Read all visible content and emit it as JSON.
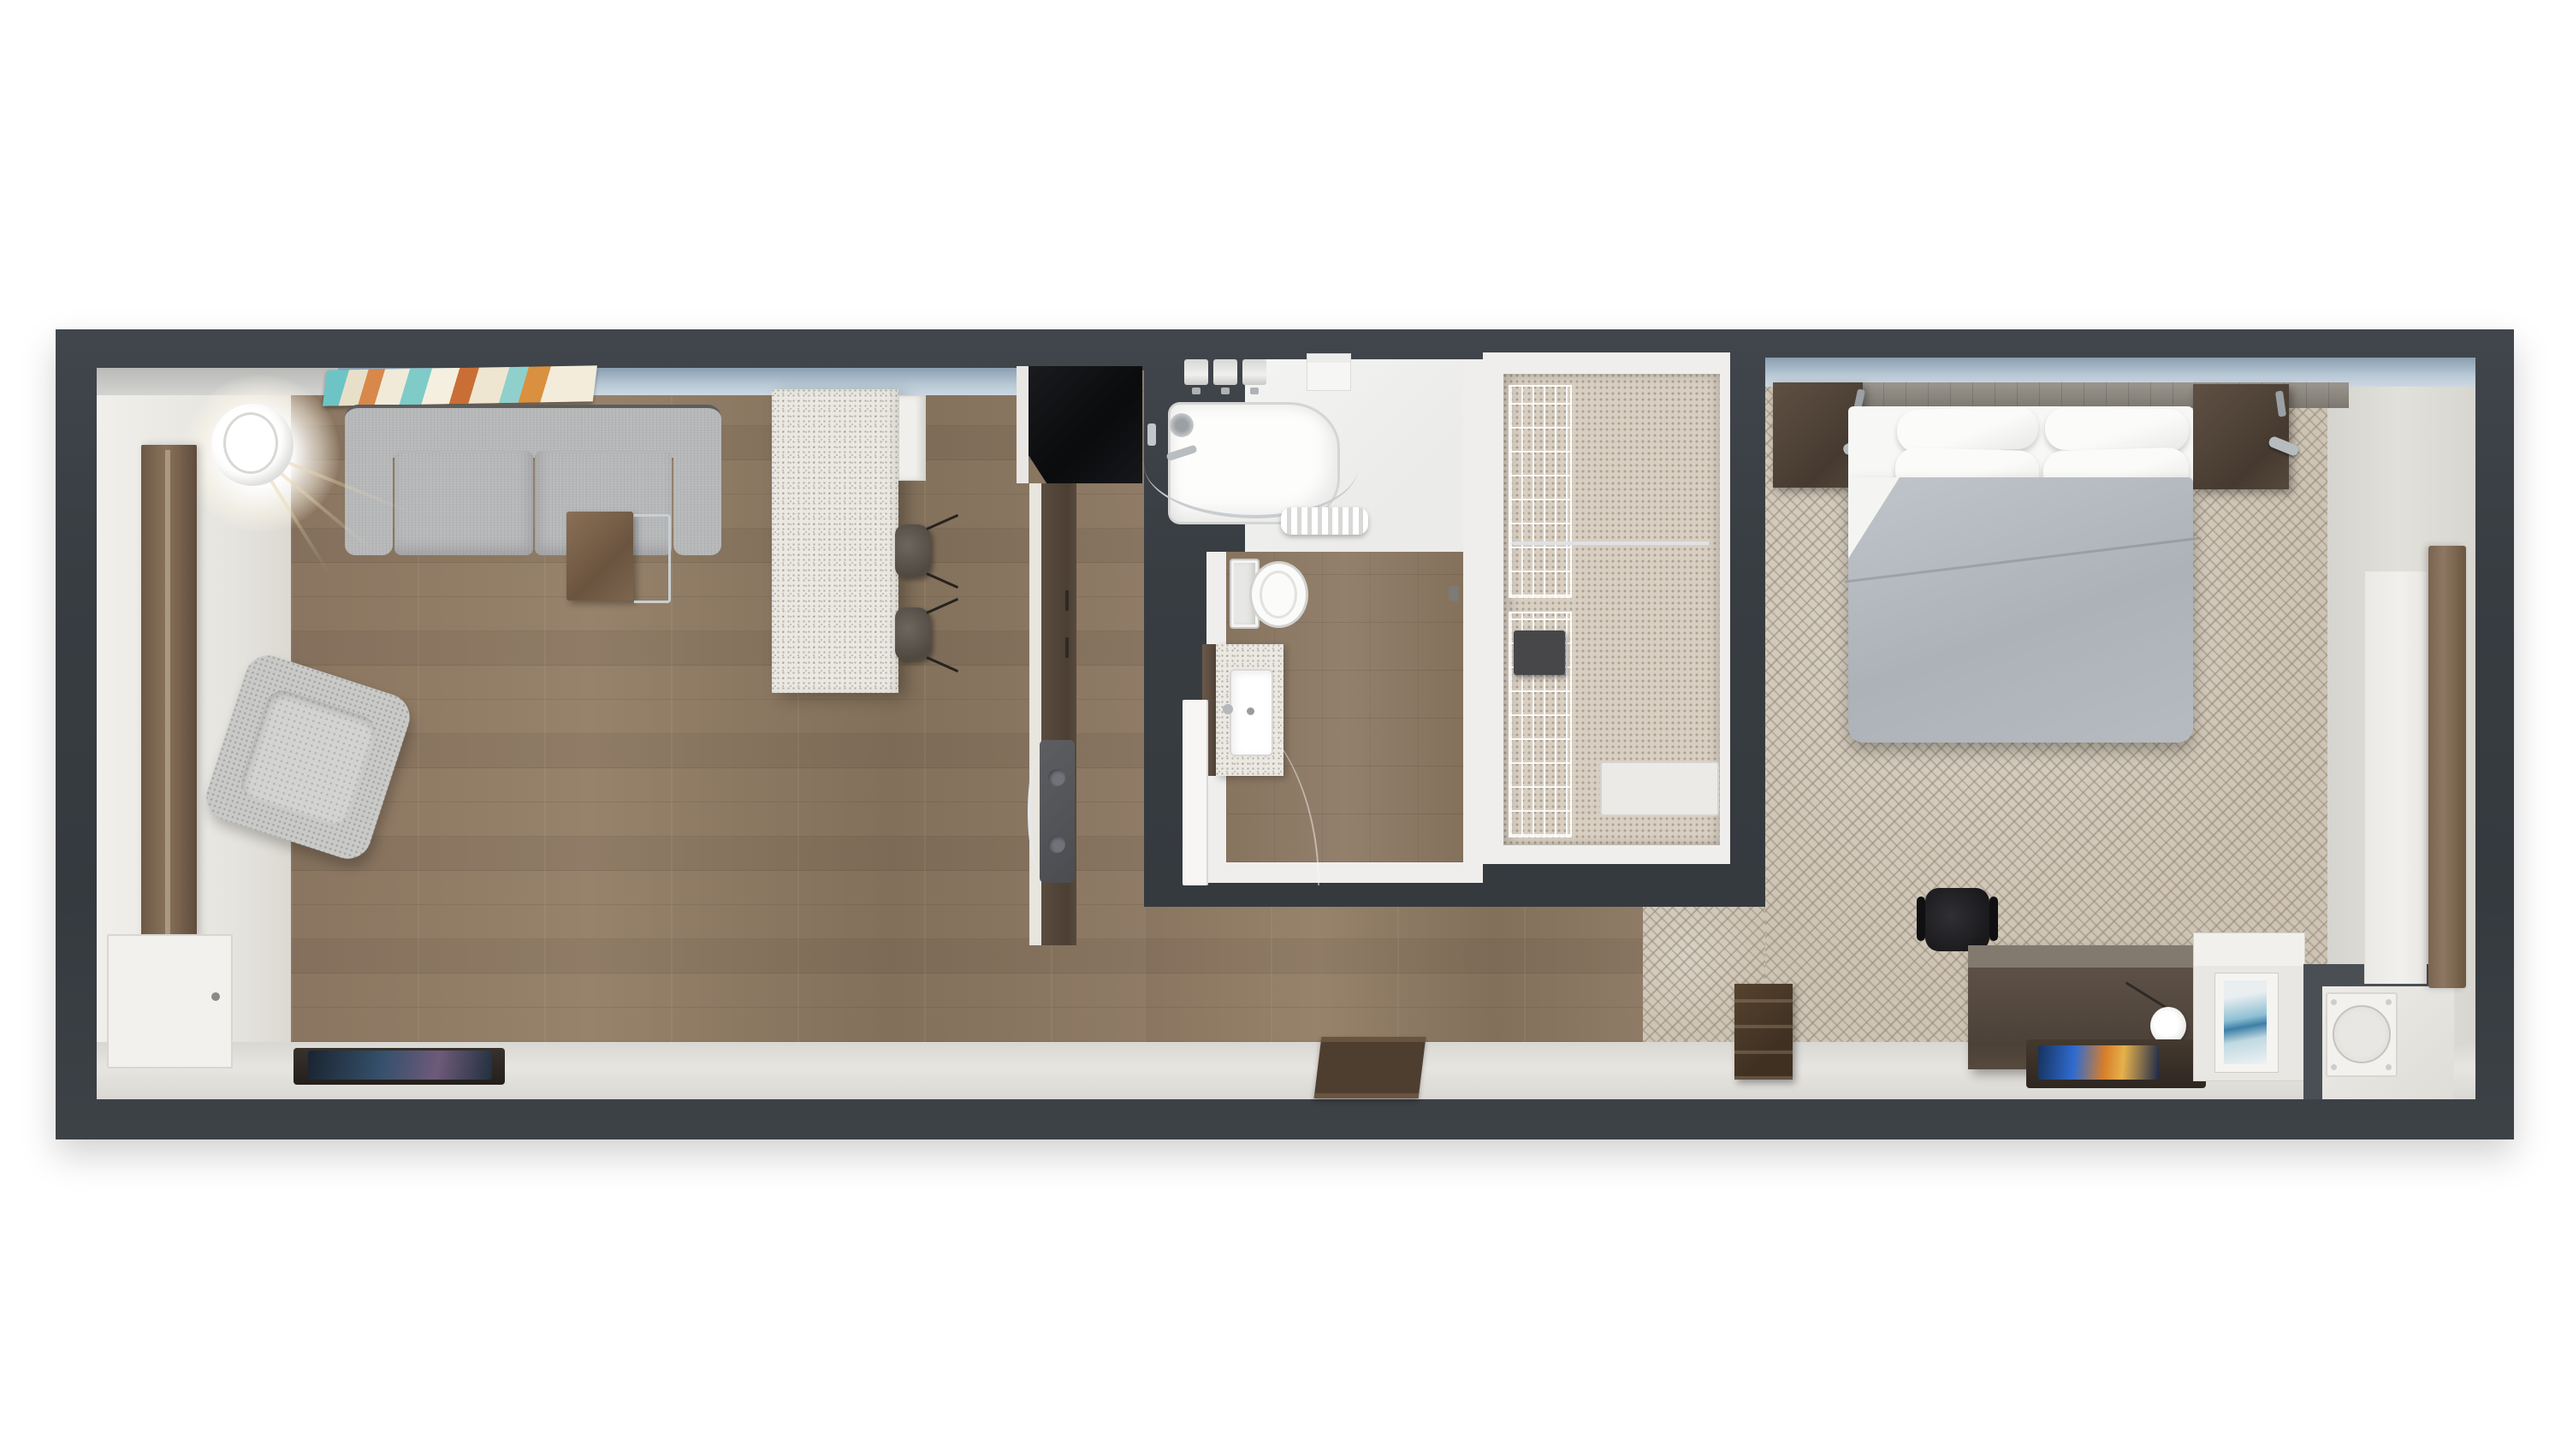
{
  "scene": {
    "type": "3d-floorplan-top-down-render",
    "title": "Hotel suite floor plan",
    "rooms": [
      {
        "name": "living-room",
        "floor": "wood-plank",
        "features": [
          "wall-art-multicolor",
          "window-strip-blue",
          "entry-foyer-white-floor"
        ],
        "furniture": [
          "sofa-two-seat-gray",
          "armchair-boucle",
          "c-side-table-wood-chrome",
          "pendant-lamp-glowing",
          "full-length-mirror-wood",
          "connecting-door",
          "tv-console",
          "wall-tv"
        ]
      },
      {
        "name": "kitchen",
        "floor": "wood-plank",
        "furniture": [
          "island-counter-speckled",
          "bar-stool",
          "bar-stool",
          "wall-cabinet",
          "refrigerator-black",
          "counter-run-dark-wood",
          "sink-with-arc-faucet"
        ]
      },
      {
        "name": "bathroom",
        "floor": "wood-look-tile",
        "furniture": [
          "bathtub-with-curved-rod",
          "shower-curtain",
          "folded-towels-x3",
          "corner-shelf",
          "toilet",
          "vanity-with-sink",
          "open-door"
        ]
      },
      {
        "name": "closet",
        "floor": "mosaic-tile",
        "furniture": [
          "wire-shelving-upper",
          "wire-shelving-lower",
          "clothes-rod",
          "safe",
          "bench"
        ]
      },
      {
        "name": "bedroom",
        "floor": "patterned-carpet",
        "features": [
          "window-strip-blue",
          "window-panel-right",
          "wood-window-sill"
        ],
        "furniture": [
          "queen-bed-gray-duvet",
          "pillows-x4",
          "headboard-panel",
          "floating-nightstand-left",
          "floating-nightstand-right",
          "reading-lamp-left",
          "reading-lamp-right",
          "desk",
          "office-chair",
          "luggage-bench",
          "tv-on-tray",
          "white-cabinet-with-art",
          "appliance-unit-round",
          "entry-mat"
        ]
      }
    ],
    "palette": {
      "page_background": "#ffffff",
      "wall": "#3a3f44",
      "wall_face_window": "#b7c8d5",
      "wood_floor": "#8e7a64",
      "carpet": "#cdc4b5",
      "entry_floor": "#e9e7e2",
      "counter_speckle": "#eae8e1",
      "sofa": "#b7b8b9",
      "duvet": "#b5bbc1",
      "fixture_white": "#f5f5f3",
      "chrome": "#c3c7ca",
      "dark_wood": "#5d5147",
      "refrigerator": "#0c0d0f",
      "tv_screen_accent": "#2f6bd0",
      "art_teal": "#7ecbc7",
      "art_orange": "#d8884a"
    }
  }
}
